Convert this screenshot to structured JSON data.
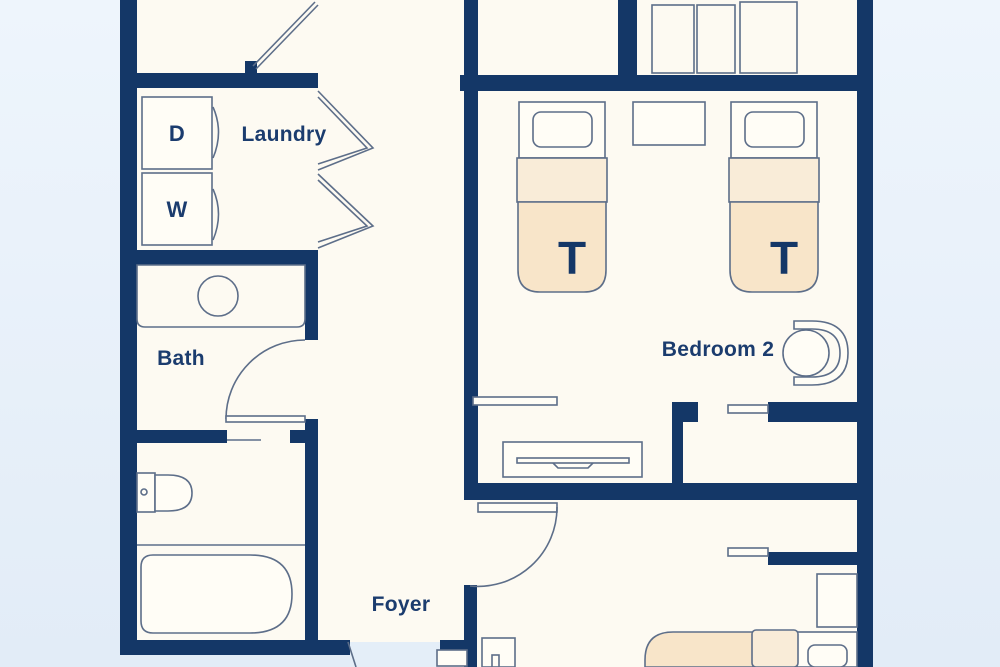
{
  "rooms": {
    "laundry": "Laundry",
    "bath": "Bath",
    "foyer": "Foyer",
    "bedroom2": "Bedroom 2"
  },
  "appliances": {
    "dryer_label": "D",
    "washer_label": "W"
  },
  "beds": {
    "twin_mark": "T"
  },
  "colors": {
    "wall": "#143767",
    "floor": "#fdfaf2",
    "background_top": "#eef5fc",
    "background_bottom": "#e2ecf7",
    "doorway": "#e4eef8",
    "bed_fill": "#f8e5c9",
    "bed_fold_fill": "#f9ecd8",
    "outline": "#5d6e89",
    "label": "#1b3c6e"
  }
}
